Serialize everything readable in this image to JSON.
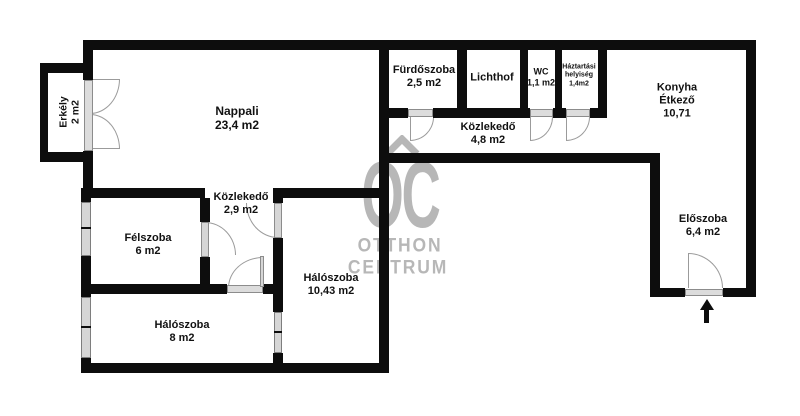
{
  "floorplan": {
    "rooms": {
      "erkely": {
        "name": "Erkély",
        "area": "2 m2"
      },
      "nappali": {
        "name": "Nappali",
        "area": "23,4 m2"
      },
      "furdoszoba": {
        "name": "Fürdőszoba",
        "area": "2,5 m2"
      },
      "lichthof": {
        "name": "Lichthof"
      },
      "wc": {
        "name": "WC",
        "area": "1,1 m2"
      },
      "haztartasi": {
        "name": "Háztartási",
        "name2": "helyiség",
        "area": "1,4m2"
      },
      "konyha": {
        "name": "Konyha",
        "name2": "Étkező",
        "area": "10,71"
      },
      "kozlekedo_felso": {
        "name": "Közlekedő",
        "area": "4,8 m2"
      },
      "kozlekedo_also": {
        "name": "Közlekedő",
        "area": "2,9 m2"
      },
      "felszoba": {
        "name": "Félszoba",
        "area": "6 m2"
      },
      "haloszoba_nagy": {
        "name": "Hálószoba",
        "area": "10,43 m2"
      },
      "haloszoba_kis": {
        "name": "Hálószoba",
        "area": "8 m2"
      },
      "eloszoba": {
        "name": "Előszoba",
        "area": "6,4 m2"
      }
    },
    "watermark": {
      "logo": "OC",
      "line1": "OTTHON",
      "line2": "CENTRUM"
    },
    "colors": {
      "wall": "#0d0d0d",
      "opening": "#d6d6d6",
      "watermark": "#b7b7b7"
    }
  }
}
